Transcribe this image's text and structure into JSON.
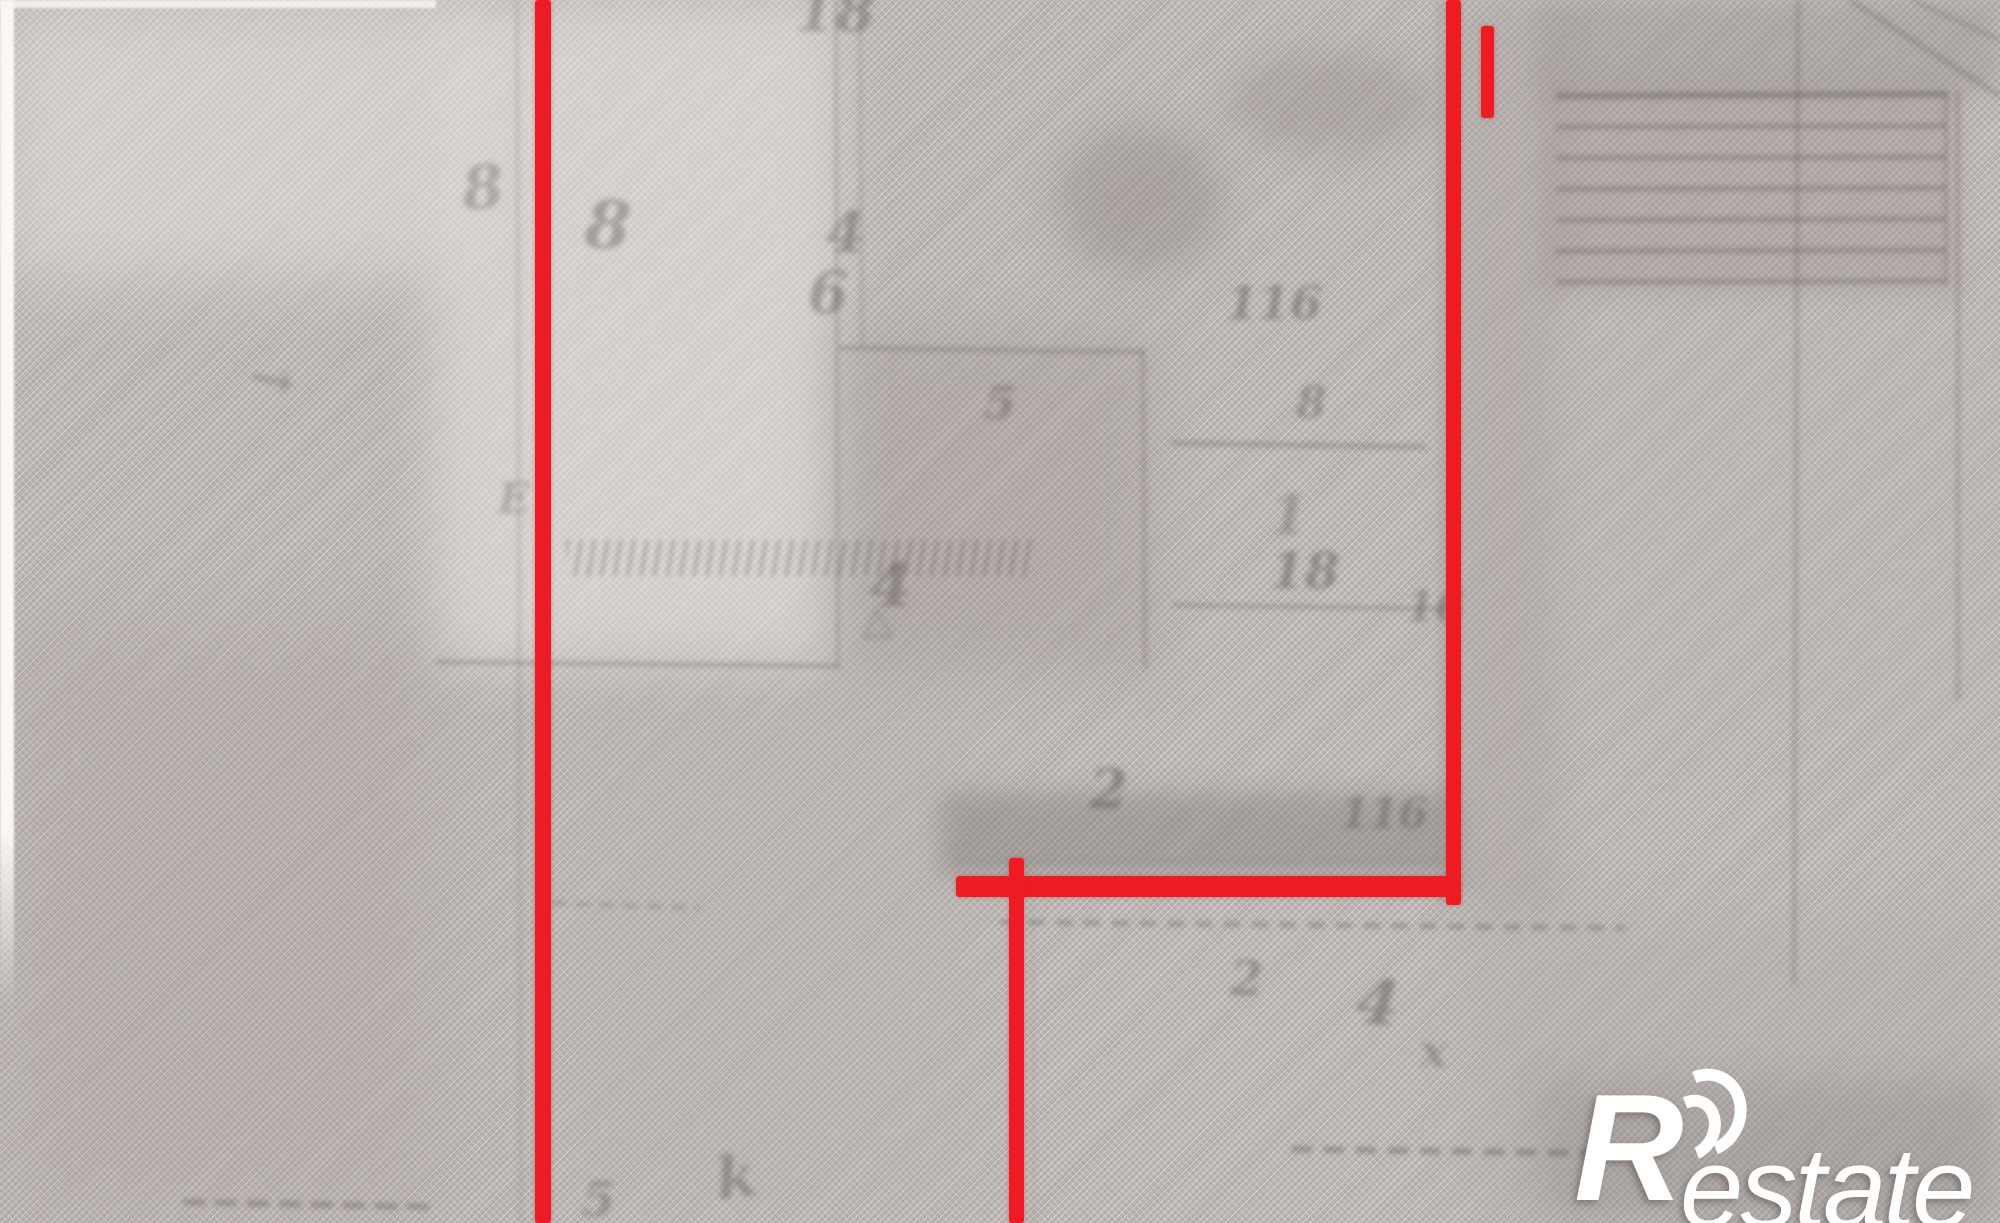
{
  "image": {
    "description": "Blurry photo of an old cadastral plan on woven textured paper; red marker lines trace plot boundaries; white real-estate watermark in the bottom-right corner",
    "paper_color": "#c7c1be",
    "red_line_color": "#ed1c24",
    "pencil_color": "#5f5955",
    "pencil_green_color": "#8e9687",
    "watermark_color": "#ffffff"
  },
  "watermark": {
    "brand_initial": "R",
    "brand_suffix": "estate",
    "full_text": "Restate"
  },
  "red_annotation": {
    "color": "#ed1c24",
    "segments": [
      {
        "name": "red-boundary-left-vertical",
        "x": 535,
        "y": 0,
        "w": 16,
        "h": 1223
      },
      {
        "name": "red-boundary-right-vertical",
        "x": 1446,
        "y": 0,
        "w": 15,
        "h": 905
      },
      {
        "name": "red-boundary-top-right-short",
        "x": 1481,
        "y": 26,
        "w": 13,
        "h": 92
      },
      {
        "name": "red-boundary-horizontal",
        "x": 956,
        "y": 876,
        "w": 504,
        "h": 21
      },
      {
        "name": "red-boundary-middle-vertical",
        "x": 1009,
        "y": 858,
        "w": 15,
        "h": 365
      }
    ]
  },
  "map_layer": {
    "lines": [
      {
        "x1": 517,
        "y1": 0,
        "x2": 521,
        "y2": 1223,
        "w": 5,
        "o": 0.28,
        "c": "g"
      },
      {
        "x1": 836,
        "y1": 0,
        "x2": 838,
        "y2": 668,
        "w": 4,
        "o": 0.22
      },
      {
        "x1": 436,
        "y1": 662,
        "x2": 838,
        "y2": 666,
        "w": 5,
        "o": 0.26
      },
      {
        "x1": 838,
        "y1": 348,
        "x2": 1143,
        "y2": 352,
        "w": 5,
        "o": 0.24
      },
      {
        "x1": 1143,
        "y1": 348,
        "x2": 1145,
        "y2": 668,
        "w": 4,
        "o": 0.22
      },
      {
        "x1": 860,
        "y1": 0,
        "x2": 862,
        "y2": 348,
        "w": 4,
        "o": 0.16
      },
      {
        "x1": 956,
        "y1": 861,
        "x2": 1458,
        "y2": 861,
        "w": 9,
        "o": 0.26,
        "c": "g"
      },
      {
        "x1": 1000,
        "y1": 922,
        "x2": 1625,
        "y2": 928,
        "w": 6,
        "o": 0.3,
        "d": "16 12"
      },
      {
        "x1": 1439,
        "y1": 0,
        "x2": 1441,
        "y2": 903,
        "w": 5,
        "o": 0.26,
        "c": "g"
      },
      {
        "x1": 1032,
        "y1": 886,
        "x2": 1034,
        "y2": 1223,
        "w": 4,
        "o": 0.2,
        "c": "g"
      },
      {
        "x1": 1798,
        "y1": 0,
        "x2": 1794,
        "y2": 985,
        "w": 5,
        "o": 0.22
      },
      {
        "x1": 1556,
        "y1": 96,
        "x2": 1948,
        "y2": 94,
        "w": 7,
        "o": 0.36
      },
      {
        "x1": 1556,
        "y1": 127,
        "x2": 1946,
        "y2": 126,
        "w": 6,
        "o": 0.28
      },
      {
        "x1": 1556,
        "y1": 158,
        "x2": 1946,
        "y2": 157,
        "w": 6,
        "o": 0.28
      },
      {
        "x1": 1556,
        "y1": 189,
        "x2": 1946,
        "y2": 188,
        "w": 6,
        "o": 0.28
      },
      {
        "x1": 1556,
        "y1": 220,
        "x2": 1946,
        "y2": 219,
        "w": 6,
        "o": 0.28
      },
      {
        "x1": 1556,
        "y1": 251,
        "x2": 1946,
        "y2": 250,
        "w": 6,
        "o": 0.28
      },
      {
        "x1": 1556,
        "y1": 282,
        "x2": 1946,
        "y2": 281,
        "w": 6,
        "o": 0.28
      },
      {
        "x1": 1946,
        "y1": 94,
        "x2": 1946,
        "y2": 286,
        "w": 4,
        "o": 0.24
      },
      {
        "x1": 1958,
        "y1": 92,
        "x2": 1958,
        "y2": 700,
        "w": 5,
        "o": 0.22
      },
      {
        "x1": 1172,
        "y1": 443,
        "x2": 1426,
        "y2": 447,
        "w": 6,
        "o": 0.26
      },
      {
        "x1": 1172,
        "y1": 605,
        "x2": 1448,
        "y2": 609,
        "w": 5,
        "o": 0.24
      },
      {
        "x1": 1292,
        "y1": 1149,
        "x2": 1645,
        "y2": 1154,
        "w": 7,
        "o": 0.36,
        "d": "20 12"
      },
      {
        "x1": 183,
        "y1": 1202,
        "x2": 437,
        "y2": 1207,
        "w": 7,
        "o": 0.32,
        "d": "22 10"
      },
      {
        "x1": 552,
        "y1": 903,
        "x2": 700,
        "y2": 908,
        "w": 5,
        "o": 0.22,
        "d": "14 10"
      },
      {
        "x1": 1850,
        "y1": 0,
        "x2": 2000,
        "y2": 96,
        "w": 6,
        "o": 0.22
      },
      {
        "x1": 1912,
        "y1": 0,
        "x2": 2000,
        "y2": 40,
        "w": 5,
        "o": 0.2
      }
    ],
    "marks": [
      {
        "t": "18",
        "x": 795,
        "y": -18,
        "s": 58,
        "o": 0.4
      },
      {
        "t": "8",
        "x": 462,
        "y": 158,
        "s": 60,
        "o": 0.35,
        "r": -6
      },
      {
        "t": "8",
        "x": 585,
        "y": 192,
        "s": 66,
        "o": 0.42,
        "r": 4
      },
      {
        "t": "4",
        "x": 826,
        "y": 205,
        "s": 56,
        "o": 0.45
      },
      {
        "t": "6",
        "x": 808,
        "y": 264,
        "s": 58,
        "o": 0.42
      },
      {
        "t": "E",
        "x": 498,
        "y": 478,
        "s": 42,
        "o": 0.32
      },
      {
        "t": "5",
        "x": 984,
        "y": 380,
        "s": 46,
        "o": 0.4
      },
      {
        "t": "4",
        "x": 870,
        "y": 556,
        "s": 60,
        "o": 0.45
      },
      {
        "t": "△",
        "x": 862,
        "y": 600,
        "s": 40,
        "o": 0.35
      },
      {
        "t": "116",
        "x": 1226,
        "y": 280,
        "s": 46,
        "o": 0.45
      },
      {
        "t": "8",
        "x": 1296,
        "y": 382,
        "s": 44,
        "o": 0.4
      },
      {
        "t": "1",
        "x": 1270,
        "y": 488,
        "s": 54,
        "o": 0.32
      },
      {
        "t": "18",
        "x": 1270,
        "y": 546,
        "s": 50,
        "o": 0.48
      },
      {
        "t": "16",
        "x": 1406,
        "y": 586,
        "s": 42,
        "o": 0.42
      },
      {
        "t": "2",
        "x": 1090,
        "y": 762,
        "s": 54,
        "o": 0.48
      },
      {
        "t": "116",
        "x": 1340,
        "y": 793,
        "s": 42,
        "o": 0.42
      },
      {
        "t": "2",
        "x": 1230,
        "y": 955,
        "s": 48,
        "o": 0.42
      },
      {
        "t": "4",
        "x": 1356,
        "y": 972,
        "s": 62,
        "o": 0.48,
        "r": 6
      },
      {
        "t": "x",
        "x": 1420,
        "y": 1028,
        "s": 46,
        "o": 0.38
      },
      {
        "t": "k",
        "x": 716,
        "y": 1148,
        "s": 58,
        "o": 0.42,
        "r": -8
      },
      {
        "t": "5",
        "x": 582,
        "y": 1176,
        "s": 48,
        "o": 0.38
      },
      {
        "t": "→",
        "x": 250,
        "y": 352,
        "s": 54,
        "o": 0.32,
        "r": 12
      }
    ],
    "tick_row": {
      "x": 566,
      "y": 540,
      "w": 470,
      "h": 36,
      "o": 0.4
    }
  }
}
